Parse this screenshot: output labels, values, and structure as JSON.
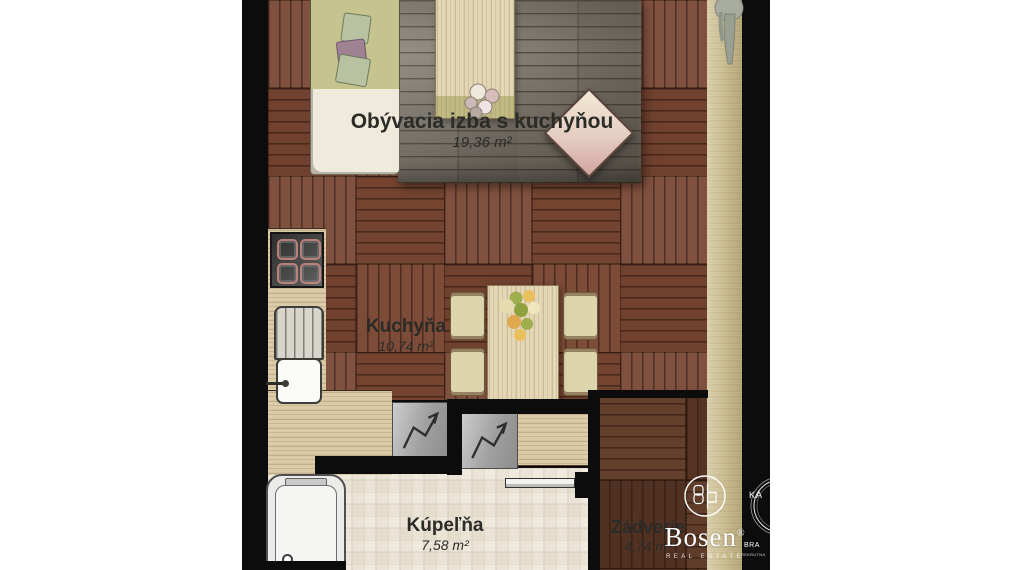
{
  "plan": {
    "kind": "apartment floor plan",
    "language": "sk"
  },
  "rooms": {
    "living": {
      "name": "Obývacia izba s kuchyňou",
      "area": "19,36 m²"
    },
    "kitchen": {
      "name": "Kuchyňa",
      "area": "10,74 m²"
    },
    "bathroom": {
      "name": "Kúpeľňa",
      "area": "7,58 m²"
    },
    "hall": {
      "name": "Zádverie",
      "area": "4,74 m²"
    }
  },
  "branding": {
    "wordmark": "Bosen",
    "registered": "®",
    "tagline": "REAL ESTATE",
    "partner": {
      "line1": "KA",
      "line2": "BRA",
      "line3": "REKRUTNA"
    }
  },
  "icons": {
    "monogram": "bosen-monogram-icon",
    "appliance_arrow": "zigzag-arrow-icon",
    "plant": "hanging-plant-icon"
  },
  "colors": {
    "wall": "#0c0c0c",
    "parquet": "#7a4936",
    "hall_parquet": "#5c3a28",
    "rug": "#878077",
    "tile": "#ebe4d6",
    "counter_wood": "#dbcba9",
    "balcony_strip": "#cdbf92",
    "label_text": "#2b2b28",
    "logo_text": "#ffffff"
  }
}
